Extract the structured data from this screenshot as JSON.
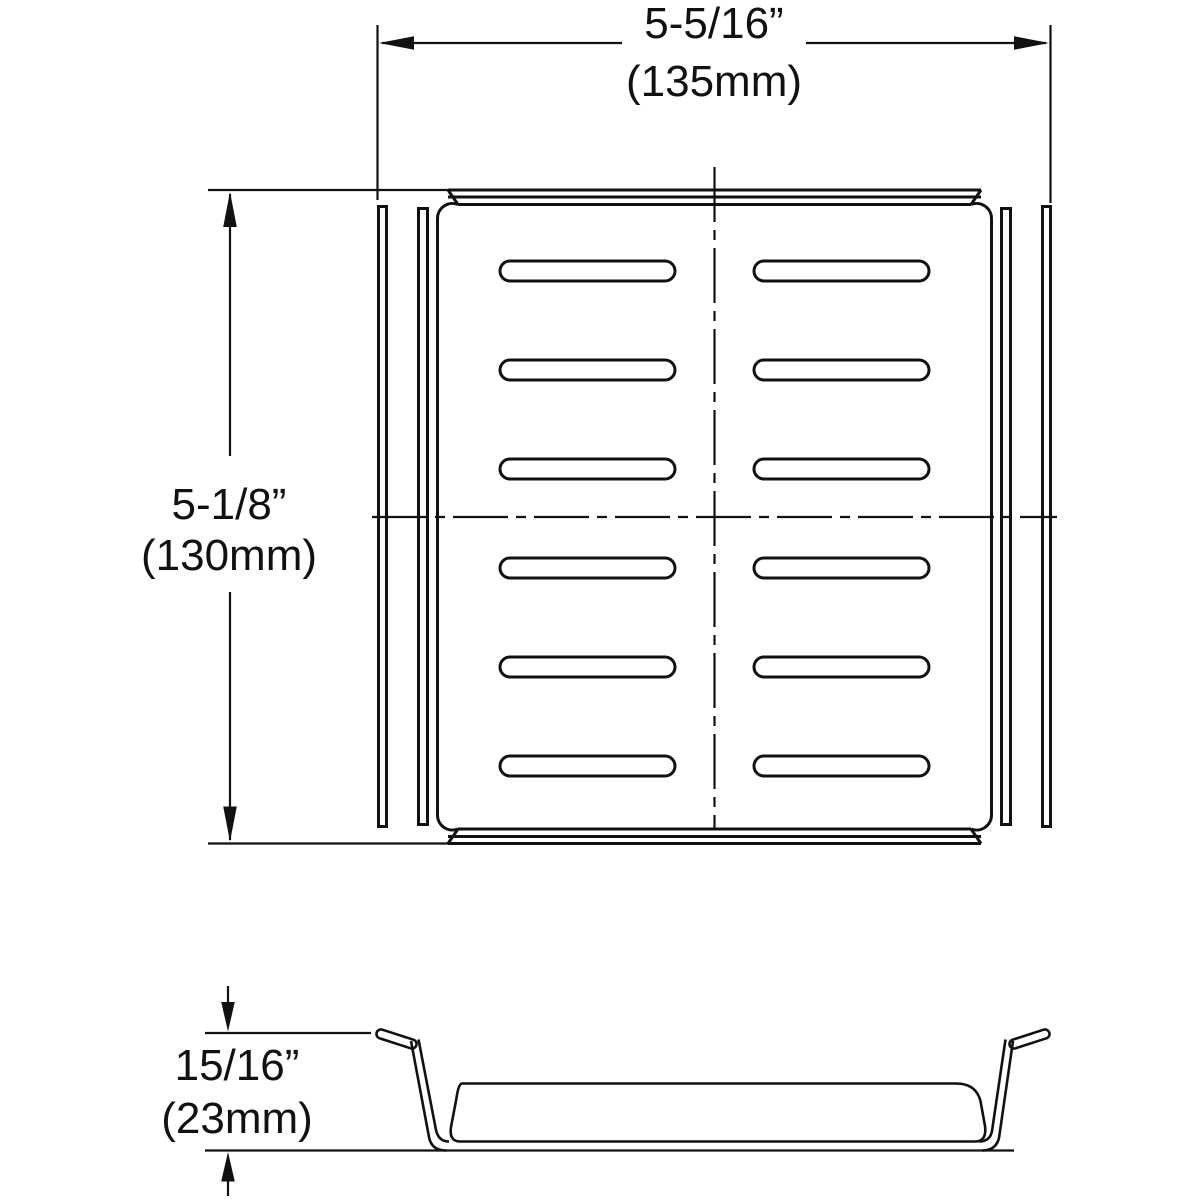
{
  "drawing": {
    "type": "dimensional-drawing",
    "colors": {
      "background": "#ffffff",
      "line": "#111111"
    },
    "plan_view": {
      "width_dimension": {
        "inches": "5-5/16”",
        "metric": "(135mm)"
      },
      "height_dimension": {
        "inches": "5-1/8”",
        "metric": "(130mm)"
      },
      "slot_grid": {
        "rows": 6,
        "columns": 2
      }
    },
    "profile_view": {
      "height_dimension": {
        "inches": "15/16”",
        "metric": "(23mm)"
      }
    }
  }
}
